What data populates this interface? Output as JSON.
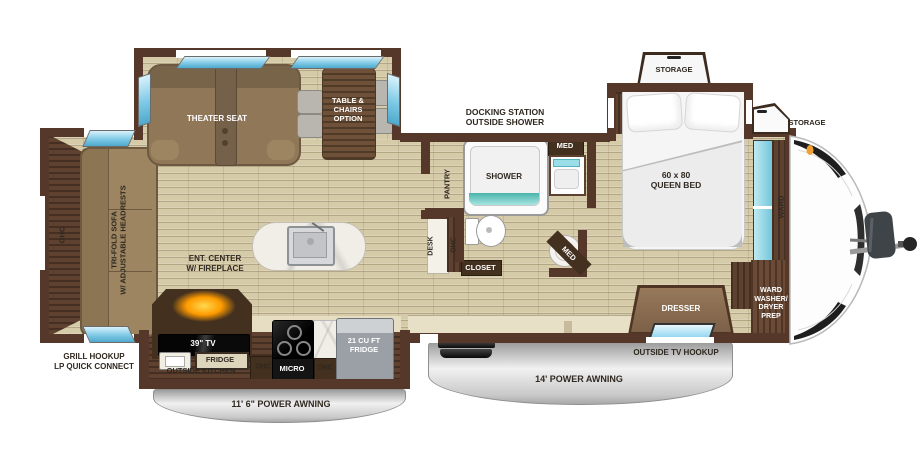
{
  "title": "Travel trailer floor plan",
  "colors": {
    "wall": "#56382a",
    "floor": "#d6cba9",
    "cabinet_wood": "#5f4130",
    "sofa_tan": "#8f7758",
    "window_blue": "#7ec9e6",
    "teal": "#7fd4cf",
    "awning_gray": "#c9c9c9",
    "appliance_black": "#151515",
    "label_dark": "#2f2820",
    "fireplace_glow": "#ff9b00"
  },
  "labels": {
    "theater_seat": "THEATER SEAT",
    "table_chairs": "TABLE &\nCHAIRS\nOPTION",
    "docking_station": "DOCKING STATION\nOUTSIDE SHOWER",
    "storage_bed": "STORAGE",
    "storage_front": "STORAGE",
    "queen_bed": "60 x 80\nQUEEN BED",
    "shower": "SHOWER",
    "med_bath": "MED",
    "med_corner": "MED",
    "pantry": "PANTRY",
    "desk": "DESK",
    "ohc_desk": "OHC",
    "closet": "CLOSET",
    "ward": "WARD",
    "ohc_rear": "OHC",
    "trifold_sofa": "TRI-FOLD SOFA\nW/ ADJUSTABLE HEADRESTS",
    "ent_center": "ENT. CENTER\nW/ FIREPLACE",
    "grill_hookup": "GRILL HOOKUP\nLP QUICK CONNECT",
    "tv_39": "39\" TV",
    "fridge_outside": "FRIDGE",
    "outside_kitchen": "OUTSIDE KITCHEN",
    "ohc_kitchen_left": "OHC",
    "micro": "MICRO",
    "ohc_kitchen_right": "OHC",
    "fridge_21": "21 CU FT\nFRIDGE",
    "awning_kitchen": "11' 6\" POWER AWNING",
    "awning_main": "14' POWER AWNING",
    "outside_tv": "OUTSIDE TV HOOKUP",
    "dresser": "DRESSER",
    "ward_washer": "WARD\nWASHER/\nDRYER\nPREP"
  }
}
